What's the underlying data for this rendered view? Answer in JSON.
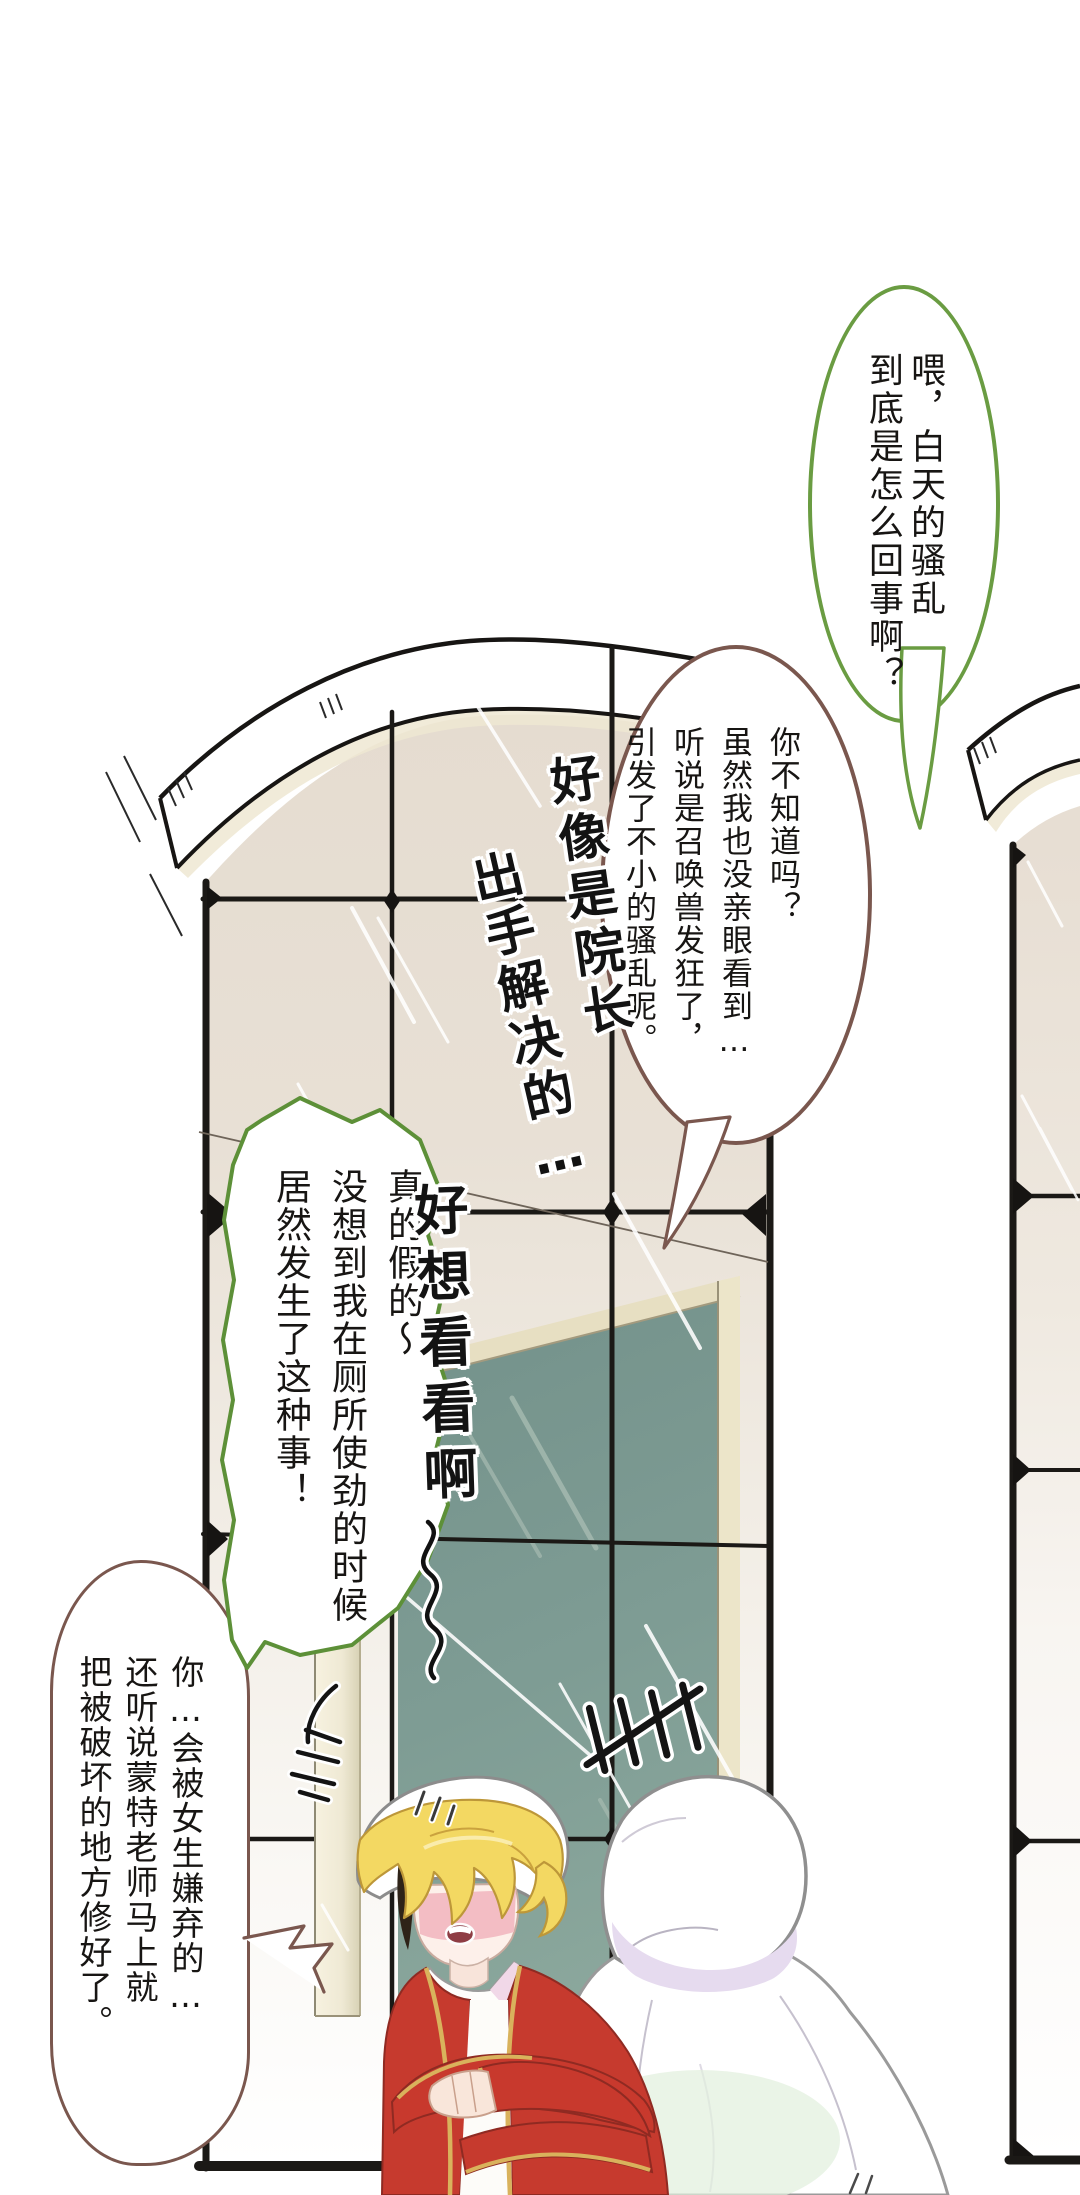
{
  "palette": {
    "bubble_green": "#6a9c42",
    "bubble_brown": "#7a574e",
    "frame_black": "#1d1b18",
    "glass_beige": "#e6ddd1",
    "board_teal": "#7d9c94",
    "board_frame_cream": "#e7dfc2",
    "jacket_red": "#c63a2e",
    "trim_gold": "#d9b25c",
    "hair_blonde": "#f3d862",
    "hood_shadow_lavender": "#e6dbef",
    "blush_pink": "#f2b8c0"
  },
  "bubbles": {
    "b1": {
      "cols": [
        "喂，白天的骚乱",
        "到底是怎么回事啊？"
      ]
    },
    "b2": {
      "cols": [
        "你不知道吗？",
        "虽然我也没亲眼看到…",
        "听说是召唤兽发狂了，",
        "引发了不小的骚乱呢。"
      ]
    },
    "b3": {
      "cols": [
        "真的假的～",
        "没想到我在厕所使劲的时候",
        "居然发生了这种事！"
      ]
    },
    "b4": {
      "cols": [
        "你…会被女生嫌弃的…",
        "还听说蒙特老师马上就",
        "把被破坏的地方修好了。"
      ]
    }
  },
  "handwriting": {
    "line1a": "好像是院长",
    "line1b": "出手解决的…",
    "line2": "好想看看啊"
  },
  "marks": {
    "tally": "tally-scratch-marks",
    "anger": "anger-scribble",
    "squiggle": "wavy-line",
    "sweat": "sweat-drops"
  }
}
